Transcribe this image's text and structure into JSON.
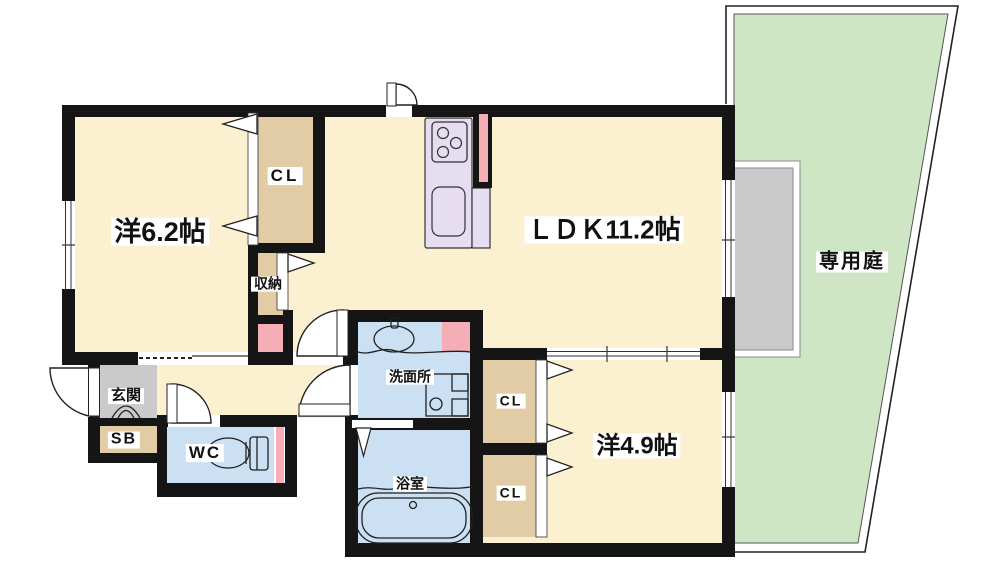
{
  "floorplan": {
    "labels": {
      "western1": "洋6.2帖",
      "closet_north": "CL",
      "storage": "収納",
      "ldk": "ＬＤＫ11.2帖",
      "garden": "専用庭",
      "genkan": "玄関",
      "shoebox": "SB",
      "wc": "WC",
      "washroom": "洗面所",
      "bathroom": "浴室",
      "closet_east_upper": "CL",
      "closet_east_lower": "CL",
      "western2": "洋4.9帖"
    },
    "colors": {
      "room_cream": "#FBF0D0",
      "closet_tan": "#E2CCA6",
      "wet_blue": "#CBE1F3",
      "accent_pink": "#F5AEB5",
      "kitchen_lavender": "#E6DDF1",
      "garden_green": "#CFE6C5",
      "terrace_gray": "#C9C9C9",
      "entry_gray": "#CACACA",
      "wall_black": "#151515"
    }
  }
}
